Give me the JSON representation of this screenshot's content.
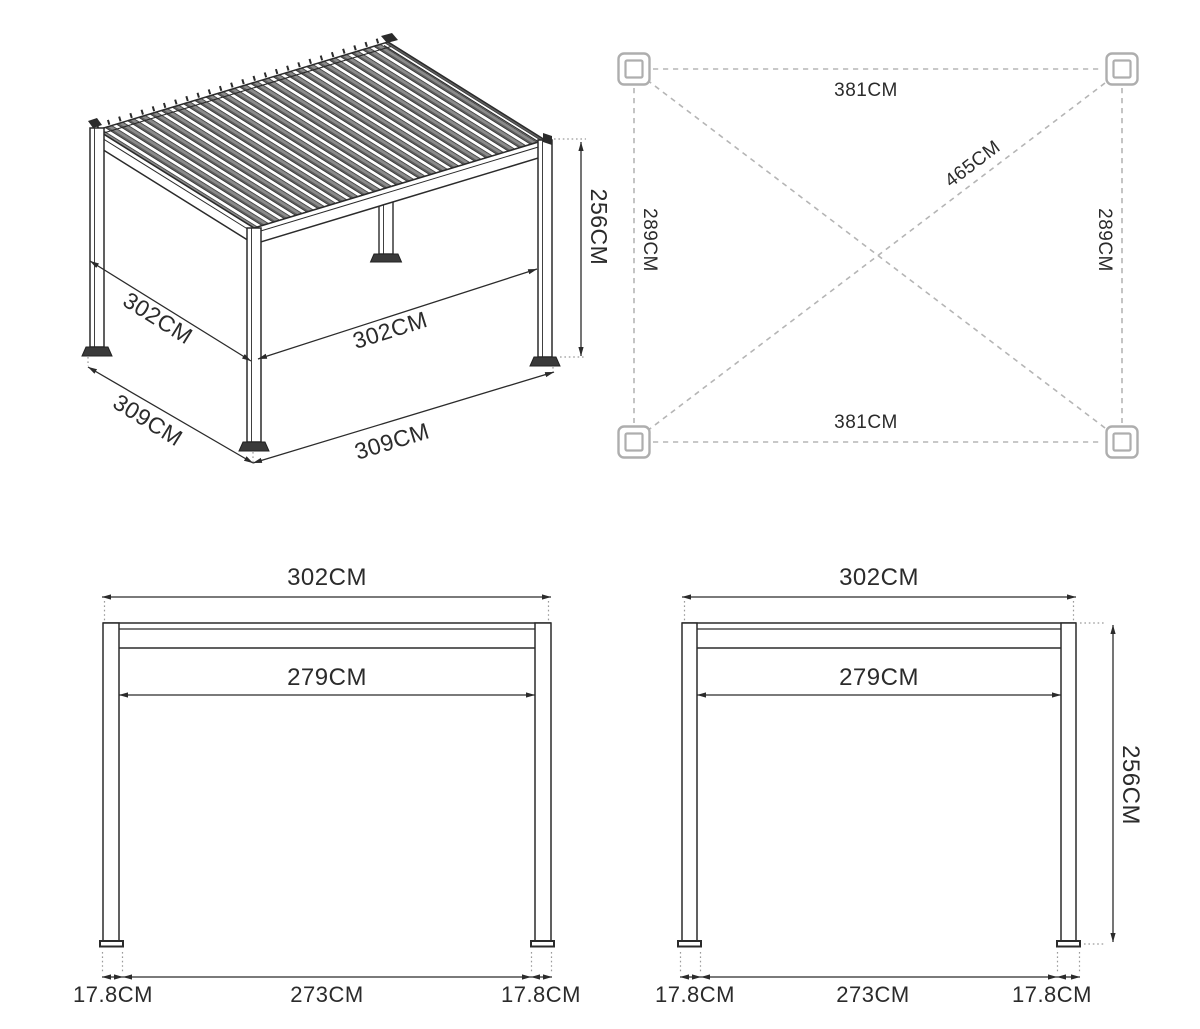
{
  "title": "Pergola dimension diagram",
  "colors": {
    "ink": "#2b2b2b",
    "louver_gray": "#8a8a8a",
    "louver_dark": "#5f5f5f",
    "plan_dash": "#b5b5b5",
    "extension_dot": "#9a9a9a",
    "corner_marker": "#aeaeae",
    "background": "#ffffff"
  },
  "iso": {
    "side": "302CM",
    "front": "302CM",
    "height": "256CM",
    "base_side": "309CM",
    "base_front": "309CM"
  },
  "plan": {
    "top": "381CM",
    "bottom": "381CM",
    "left": "289CM",
    "right": "289CM",
    "diagonal": "465CM"
  },
  "front_view": {
    "width": "302CM",
    "inner": "279CM",
    "foot_left": "17.8CM",
    "span": "273CM",
    "foot_right": "17.8CM"
  },
  "side_view": {
    "width": "302CM",
    "inner": "279CM",
    "height": "256CM",
    "foot_left": "17.8CM",
    "span": "273CM",
    "foot_right": "17.8CM"
  }
}
